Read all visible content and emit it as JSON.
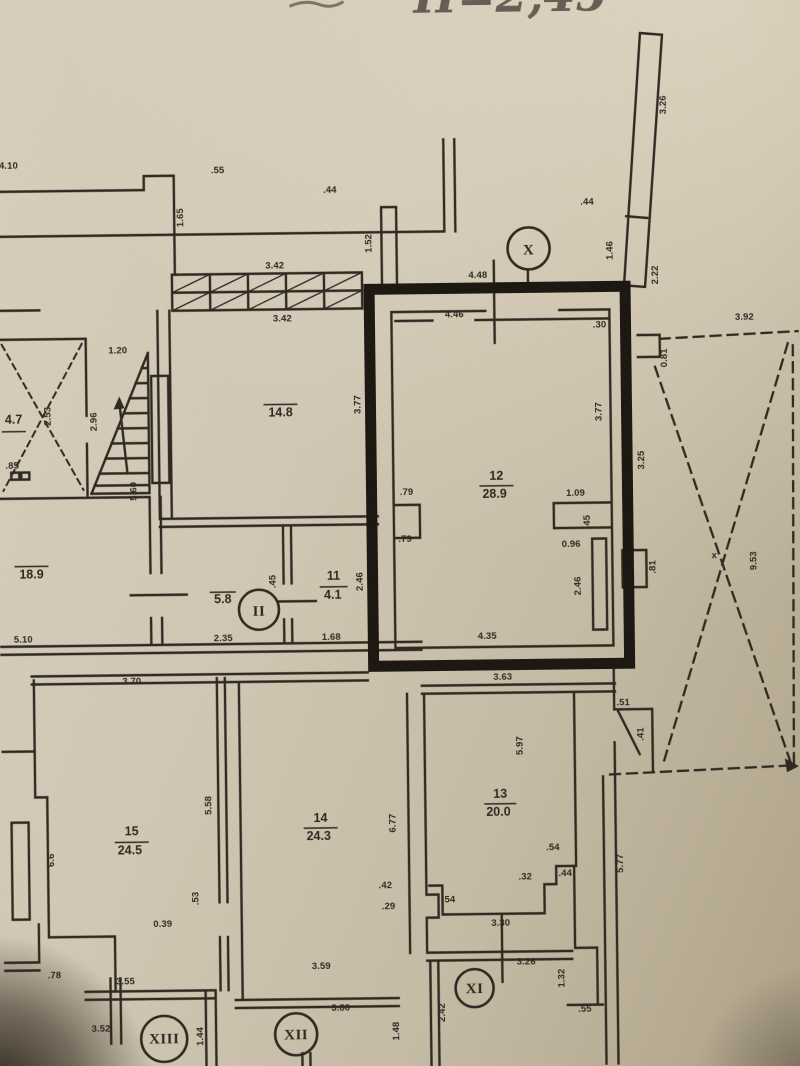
{
  "photo": {
    "handwriting": "H=2,45"
  },
  "colors": {
    "ink": "#2e2720",
    "thick": "#1a1510",
    "hand": "#48413a"
  },
  "plan": {
    "section_markers": [
      {
        "label": "X",
        "x": 532,
        "y": 250,
        "r": 21,
        "fs": 17
      },
      {
        "label": "II",
        "x": 258,
        "y": 608,
        "r": 20,
        "fs": 16
      },
      {
        "label": "XI",
        "x": 469,
        "y": 989,
        "r": 19,
        "fs": 14
      },
      {
        "label": "XII",
        "x": 290,
        "y": 1033,
        "r": 21,
        "fs": 14
      },
      {
        "label": "XIII",
        "x": 158,
        "y": 1036,
        "r": 23,
        "fs": 12.5
      }
    ],
    "room_labels": [
      {
        "number": "12",
        "area": "28.9",
        "nx": 497,
        "ny": 481,
        "ax": 495,
        "ay": 499,
        "line": [
          480,
          487,
          514,
          487
        ]
      },
      {
        "number": "13",
        "area": "20.0",
        "nx": 497,
        "ny": 799,
        "ax": 495,
        "ay": 817,
        "line": [
          481,
          805,
          513,
          805
        ]
      },
      {
        "number": "14",
        "area": "24.3",
        "nx": 317,
        "ny": 821,
        "ax": 315,
        "ay": 839,
        "line": [
          300,
          827,
          334,
          827
        ]
      },
      {
        "number": "15",
        "area": "24.5",
        "nx": 128,
        "ny": 832,
        "ax": 126,
        "ay": 851,
        "line": [
          111,
          839,
          145,
          839
        ]
      },
      {
        "number": "11",
        "area": "4.1",
        "nx": 333,
        "ny": 579,
        "ax": 332,
        "ay": 598,
        "line": [
          319,
          586,
          347,
          586
        ]
      },
      {
        "area": "14.8",
        "ax": 282,
        "ay": 415,
        "line": [
          265,
          403,
          299,
          403
        ]
      },
      {
        "area": "18.9",
        "ax": 31,
        "ay": 574,
        "line": [
          14,
          562,
          48,
          562
        ]
      },
      {
        "area": "5.8",
        "ax": 222,
        "ay": 601,
        "line": [
          209,
          590,
          235,
          590
        ]
      },
      {
        "area": "4.7",
        "ax": 15,
        "ay": 419,
        "line": [
          3,
          427,
          27,
          427
        ]
      }
    ],
    "dimension_labels": [
      {
        "t": "4.10",
        "x": 13,
        "y": 164
      },
      {
        "t": ".55",
        "x": 222,
        "y": 171
      },
      {
        "t": "1.65",
        "x": 187,
        "y": 215,
        "rot": -90
      },
      {
        "t": ".44",
        "x": 334,
        "y": 192
      },
      {
        "t": "1.52",
        "x": 375,
        "y": 243,
        "rot": -90
      },
      {
        "t": "3.42",
        "x": 278,
        "y": 267
      },
      {
        "t": "3.42",
        "x": 285,
        "y": 320
      },
      {
        "t": "3.26",
        "x": 671,
        "y": 108,
        "rot": -90,
        "s": 11
      },
      {
        "t": ".44",
        "x": 591,
        "y": 207
      },
      {
        "t": "1.46",
        "x": 616,
        "y": 253,
        "rot": -90
      },
      {
        "t": "2.22",
        "x": 661,
        "y": 278,
        "rot": -90
      },
      {
        "t": "4.48",
        "x": 481,
        "y": 279
      },
      {
        "t": "3.92",
        "x": 747,
        "y": 324,
        "s": 11
      },
      {
        "t": "0.81",
        "x": 669,
        "y": 361,
        "rot": -90
      },
      {
        "t": "9.53",
        "x": 756,
        "y": 565,
        "rot": -90,
        "s": 11
      },
      {
        "t": "x",
        "x": 714,
        "y": 562
      },
      {
        "t": "3.25",
        "x": 645,
        "y": 463,
        "rot": -90
      },
      {
        "t": ".30",
        "x": 602,
        "y": 330
      },
      {
        "t": "4.46",
        "x": 457,
        "y": 318
      },
      {
        "t": "3.77",
        "x": 603,
        "y": 414,
        "rot": -90
      },
      {
        "t": "3.77",
        "x": 362,
        "y": 404,
        "rot": -90
      },
      {
        "t": ".79",
        "x": 407,
        "y": 495
      },
      {
        "t": ".79",
        "x": 405,
        "y": 542
      },
      {
        "t": "1.09",
        "x": 576,
        "y": 498
      },
      {
        "t": ".45",
        "x": 590,
        "y": 524,
        "rot": -90
      },
      {
        "t": "0.96",
        "x": 571,
        "y": 549
      },
      {
        "t": "2.46",
        "x": 580,
        "y": 588,
        "rot": -90
      },
      {
        "t": ".81",
        "x": 655,
        "y": 570,
        "rot": -90
      },
      {
        "t": "4.35",
        "x": 486,
        "y": 640
      },
      {
        "t": "3.63",
        "x": 501,
        "y": 681
      },
      {
        "t": ".51",
        "x": 621,
        "y": 708
      },
      {
        "t": ".41",
        "x": 641,
        "y": 737,
        "rot": -90
      },
      {
        "t": "5.77",
        "x": 619,
        "y": 866,
        "rot": -90
      },
      {
        "t": "5.97",
        "x": 520,
        "y": 747,
        "rot": -90
      },
      {
        "t": ".54",
        "x": 549,
        "y": 852
      },
      {
        "t": ".32",
        "x": 521,
        "y": 881
      },
      {
        "t": ".44",
        "x": 561,
        "y": 878
      },
      {
        "t": ".54",
        "x": 444,
        "y": 903
      },
      {
        "t": "3.30",
        "x": 496,
        "y": 927
      },
      {
        "t": "3.26",
        "x": 521,
        "y": 966
      },
      {
        "t": "1.32",
        "x": 559,
        "y": 980,
        "rot": -90
      },
      {
        "t": ".55",
        "x": 579,
        "y": 1014
      },
      {
        "t": "2.42",
        "x": 439,
        "y": 1013,
        "rot": -90
      },
      {
        "t": "1.48",
        "x": 393,
        "y": 1031,
        "rot": -90
      },
      {
        "t": "6.77",
        "x": 392,
        "y": 823,
        "rot": -90
      },
      {
        "t": ".42",
        "x": 381,
        "y": 888
      },
      {
        "t": ".29",
        "x": 384,
        "y": 909
      },
      {
        "t": "3.59",
        "x": 316,
        "y": 968
      },
      {
        "t": "3.80",
        "x": 335,
        "y": 1010
      },
      {
        "t": "3.70",
        "x": 130,
        "y": 681
      },
      {
        "t": "5.58",
        "x": 208,
        "y": 803,
        "rot": -90
      },
      {
        "t": "6.6",
        "x": 50,
        "y": 856,
        "rot": -90
      },
      {
        "t": ".53",
        "x": 194,
        "y": 896,
        "rot": -90
      },
      {
        "t": "0.39",
        "x": 158,
        "y": 924
      },
      {
        "t": ".78",
        "x": 49,
        "y": 974
      },
      {
        "t": "3.55",
        "x": 120,
        "y": 981
      },
      {
        "t": "3.52",
        "x": 95,
        "y": 1028
      },
      {
        "t": "1.44",
        "x": 197,
        "y": 1034,
        "rot": -90
      },
      {
        "t": "5.10",
        "x": 22,
        "y": 638
      },
      {
        "t": ".85",
        "x": 13,
        "y": 464
      },
      {
        "t": "2.53",
        "x": 52,
        "y": 412,
        "rot": -90
      },
      {
        "t": "2.96",
        "x": 98,
        "y": 418,
        "rot": -90
      },
      {
        "t": "1.20",
        "x": 120,
        "y": 350
      },
      {
        "t": "5.60",
        "x": 137,
        "y": 488,
        "rot": -90
      },
      {
        "t": "2.35",
        "x": 222,
        "y": 639
      },
      {
        "t": "1.68",
        "x": 330,
        "y": 639
      },
      {
        "t": ".45",
        "x": 275,
        "y": 580,
        "rot": -90
      },
      {
        "t": "2.46",
        "x": 362,
        "y": 581,
        "rot": -90
      }
    ]
  }
}
